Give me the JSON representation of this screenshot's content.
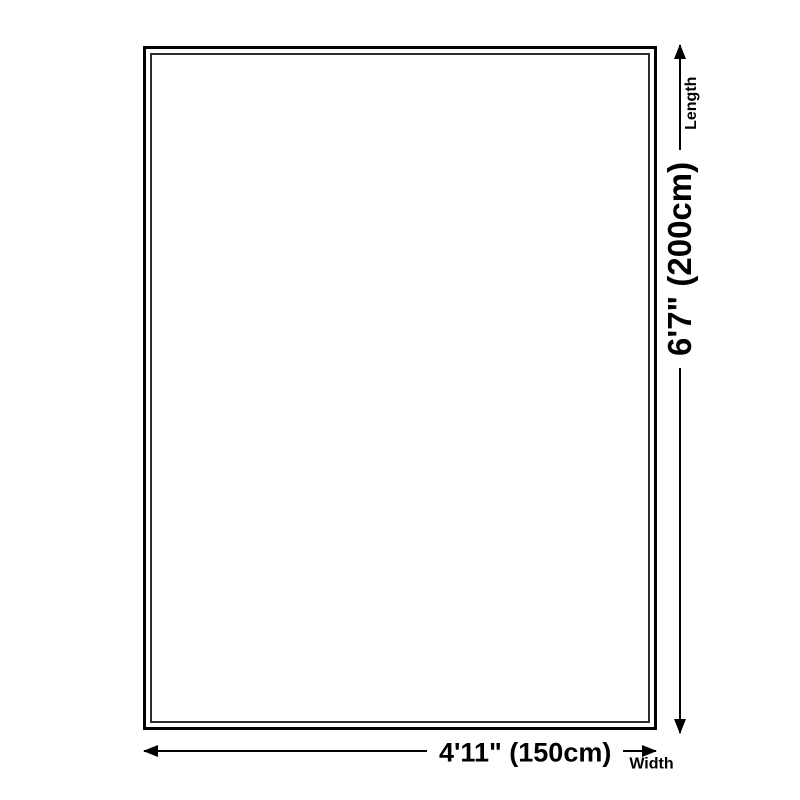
{
  "canvas": {
    "background": "#ffffff",
    "line_color": "#000000"
  },
  "dimensions": {
    "length": {
      "value": "6'7\" (200cm)",
      "label": "Length"
    },
    "width": {
      "value": "4'11\" (150cm)",
      "label": "Width"
    }
  }
}
